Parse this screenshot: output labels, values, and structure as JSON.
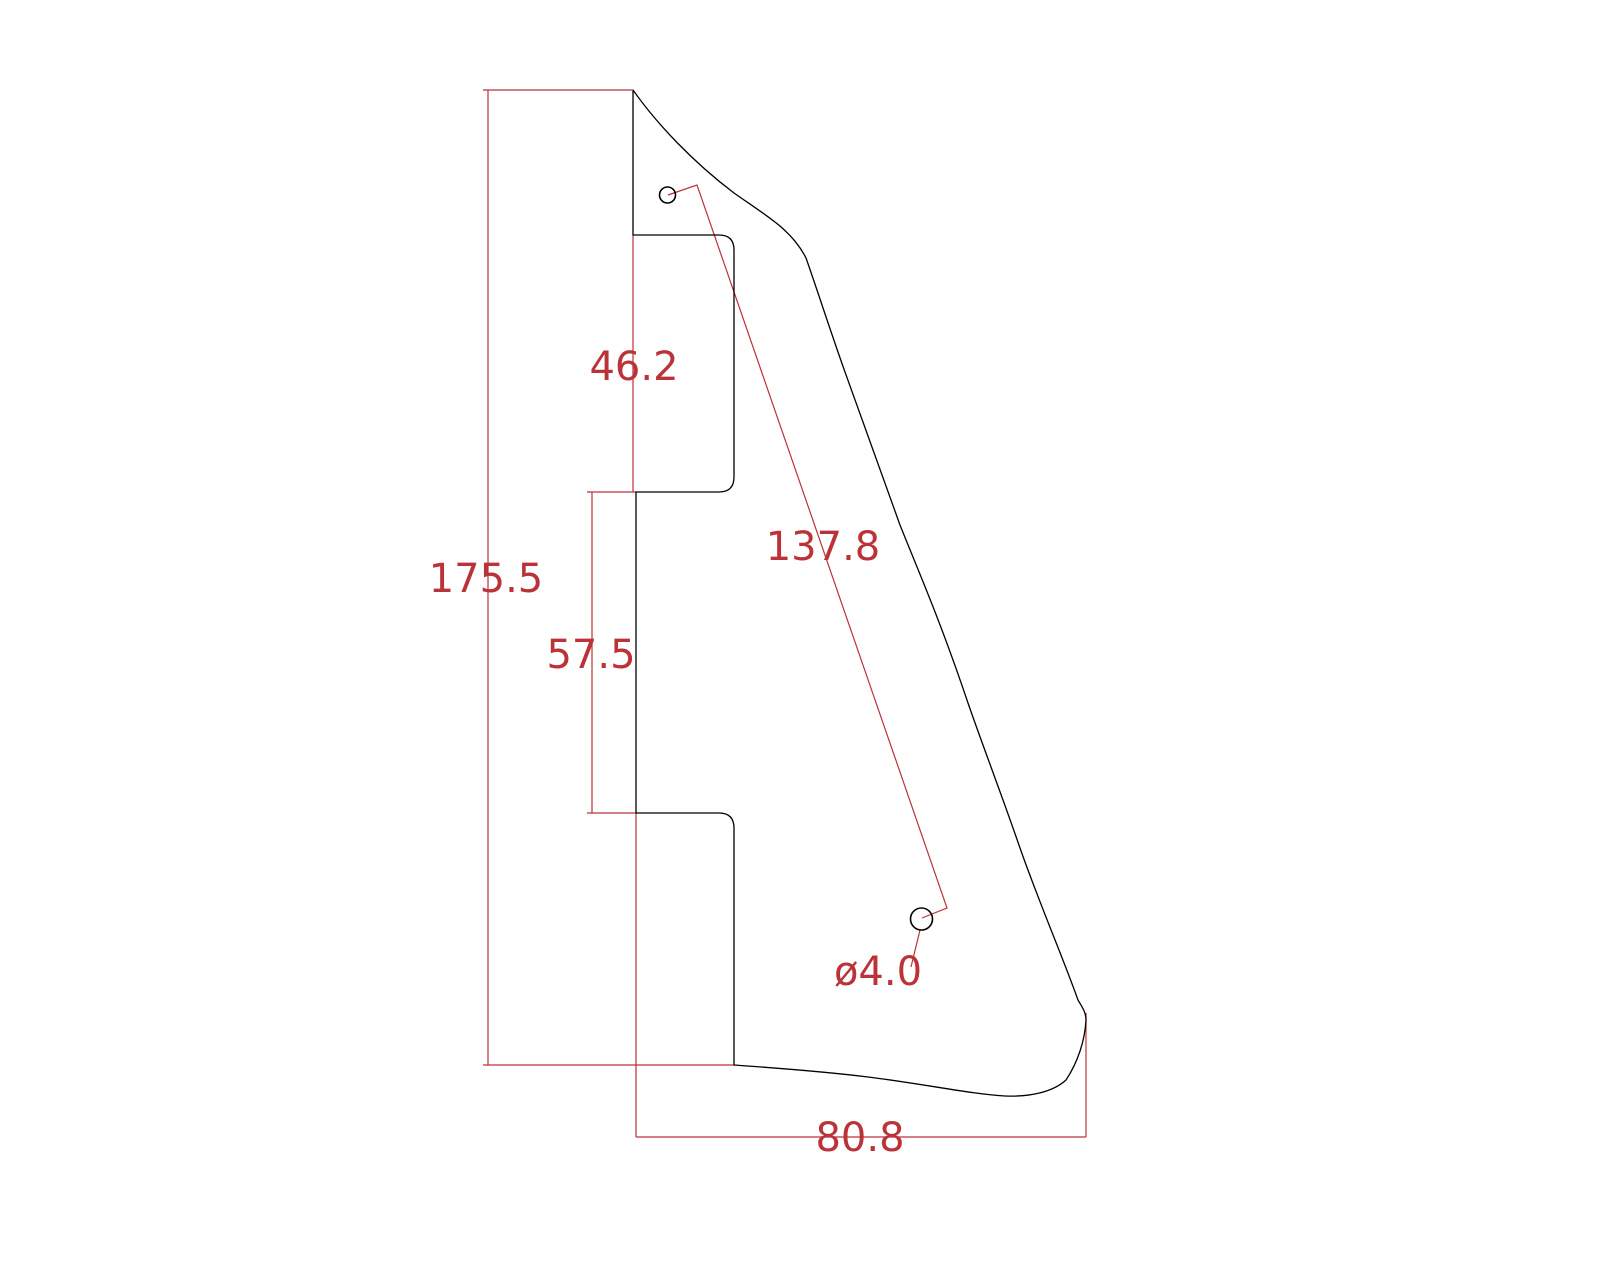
{
  "drawing": {
    "colors": {
      "background": "#ffffff",
      "outline": "#000000",
      "dimension": "#bb3339"
    },
    "dimensions": {
      "overall_height": "175.5",
      "pickup_cutout_height": "46.2",
      "left_edge_middle_height": "57.5",
      "hole_center_distance": "137.8",
      "overall_width": "80.8",
      "hole_diameter": "ø4.0"
    }
  }
}
